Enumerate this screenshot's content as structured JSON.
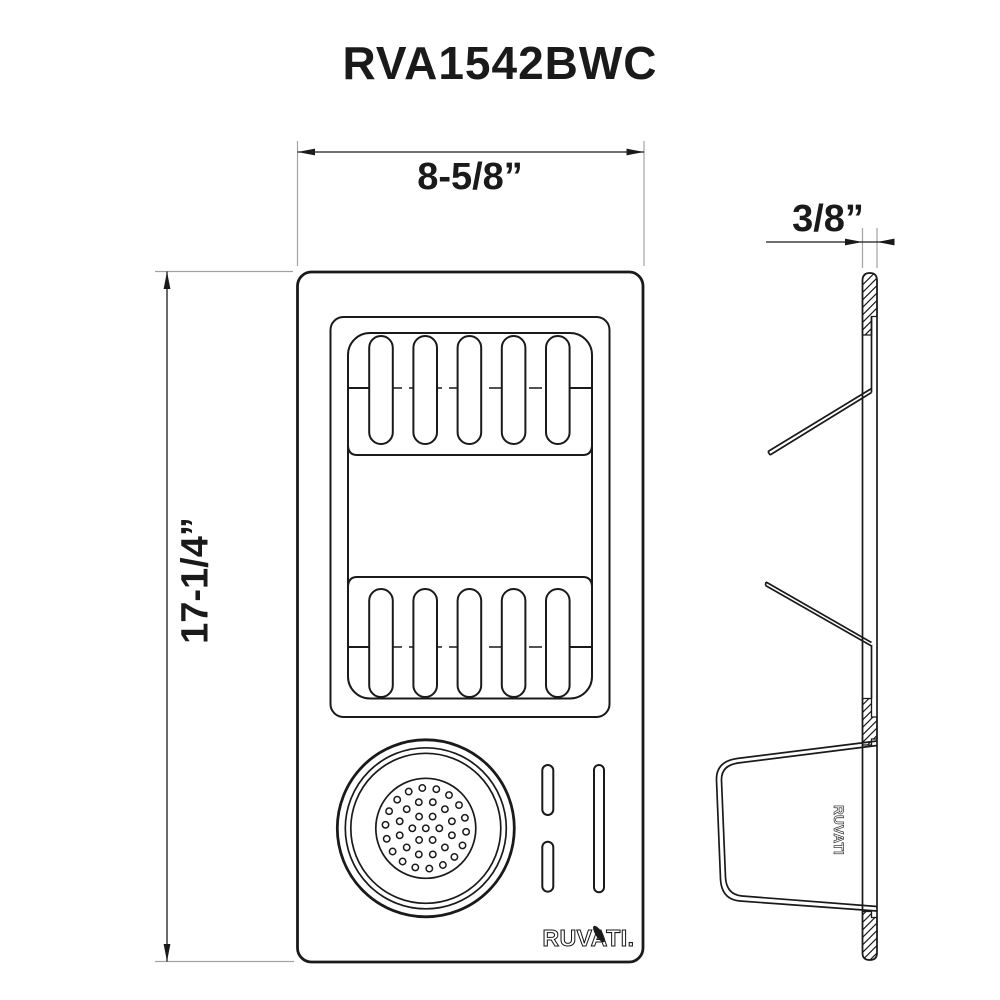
{
  "title": "RVA1542BWC",
  "dimensions": {
    "width_label": "8-5/8”",
    "height_label": "17-1/4”",
    "thickness_label": "3/8”"
  },
  "brand": {
    "front_logo": "RUVATI.",
    "side_logo": "RUVATI"
  },
  "icons": {
    "logo_leaf": "leaf-icon"
  },
  "colors": {
    "line": "#1a1a1a",
    "extension_line": "#a3a3a3",
    "background": "#ffffff"
  }
}
